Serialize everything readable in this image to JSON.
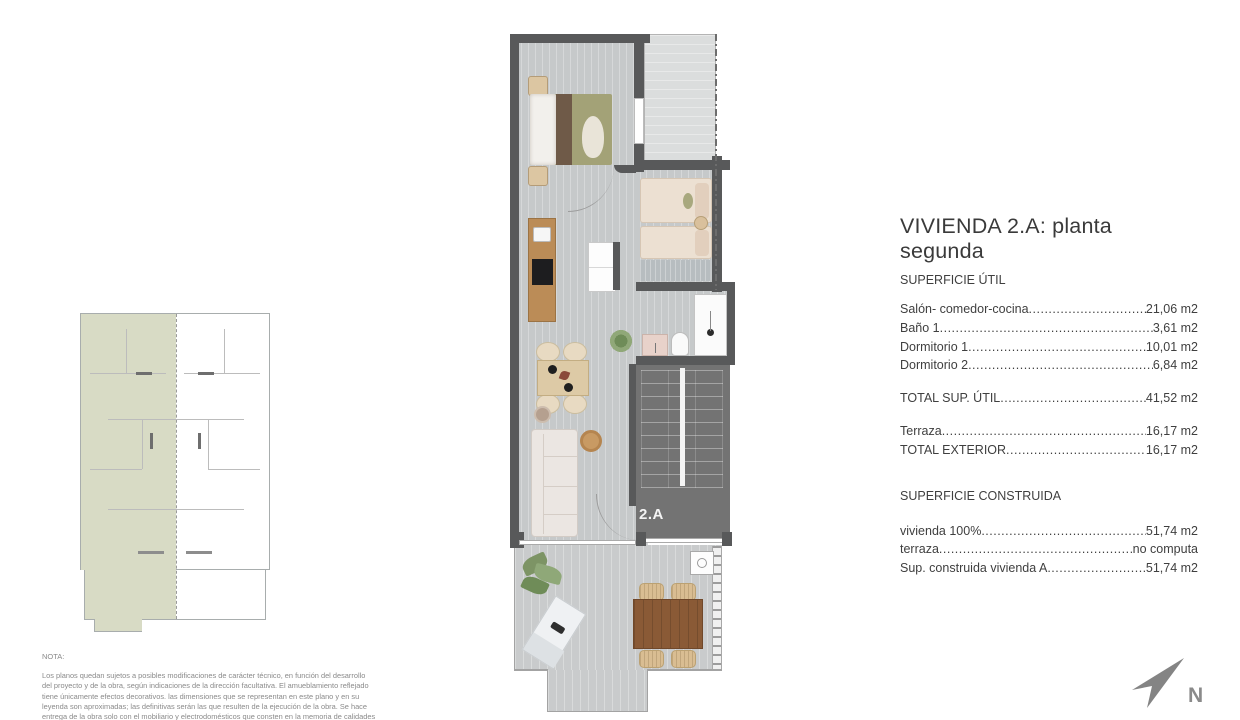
{
  "legend": {
    "title": "VIVIENDA 2.A: planta segunda",
    "util": {
      "heading": "SUPERFICIE ÚTIL",
      "rows": [
        {
          "label": "Salón- comedor-cocina",
          "value": "21,06 m2"
        },
        {
          "label": "Baño 1",
          "value": "3,61 m2"
        },
        {
          "label": "Dormitorio 1",
          "value": "10,01 m2"
        },
        {
          "label": "Dormitorio 2",
          "value": "6,84 m2"
        }
      ],
      "total": {
        "label": "TOTAL SUP. ÚTIL",
        "value": "41,52 m2"
      },
      "exterior_rows": [
        {
          "label": "Terraza",
          "value": "16,17 m2"
        },
        {
          "label": "TOTAL EXTERIOR",
          "value": "16,17 m2"
        }
      ]
    },
    "construida": {
      "heading": "SUPERFICIE CONSTRUIDA",
      "rows": [
        {
          "label": "vivienda 100%",
          "value": "51,74 m2"
        },
        {
          "label": "terraza",
          "value": "no computa"
        },
        {
          "label": "Sup. construida vivienda A",
          "value": "51,74 m2"
        }
      ]
    }
  },
  "plan": {
    "unit_label": "2.A"
  },
  "nota": {
    "heading": "NOTA:",
    "lines": [
      "Los planos quedan sujetos a posibles modificaciones de carácter técnico, en función del desarrollo",
      "del proyecto y de la obra, según indicaciones de la dirección facultativa. El amueblamiento reflejado",
      "tiene únicamente efectos decorativos. las dimensiones que se representan en este plano y en su",
      "leyenda son aproximadas; las definitivas serán las que resulten de la ejecución de la obra. Se hace",
      "entrega de la obra solo con el mobiliario y electrodomésticos que consten en la memoria de calidades"
    ]
  },
  "north": {
    "label": "N"
  },
  "colors": {
    "wall": "#58595a",
    "floor": "#c6c9ca",
    "stairs": "#737373",
    "keyplan_highlight": "#d8dbc5",
    "bed_olive": "#a3a277",
    "terrace_wood": "#8a5a36",
    "text": "#3f3f3f",
    "note_text": "#8a8a8a"
  }
}
